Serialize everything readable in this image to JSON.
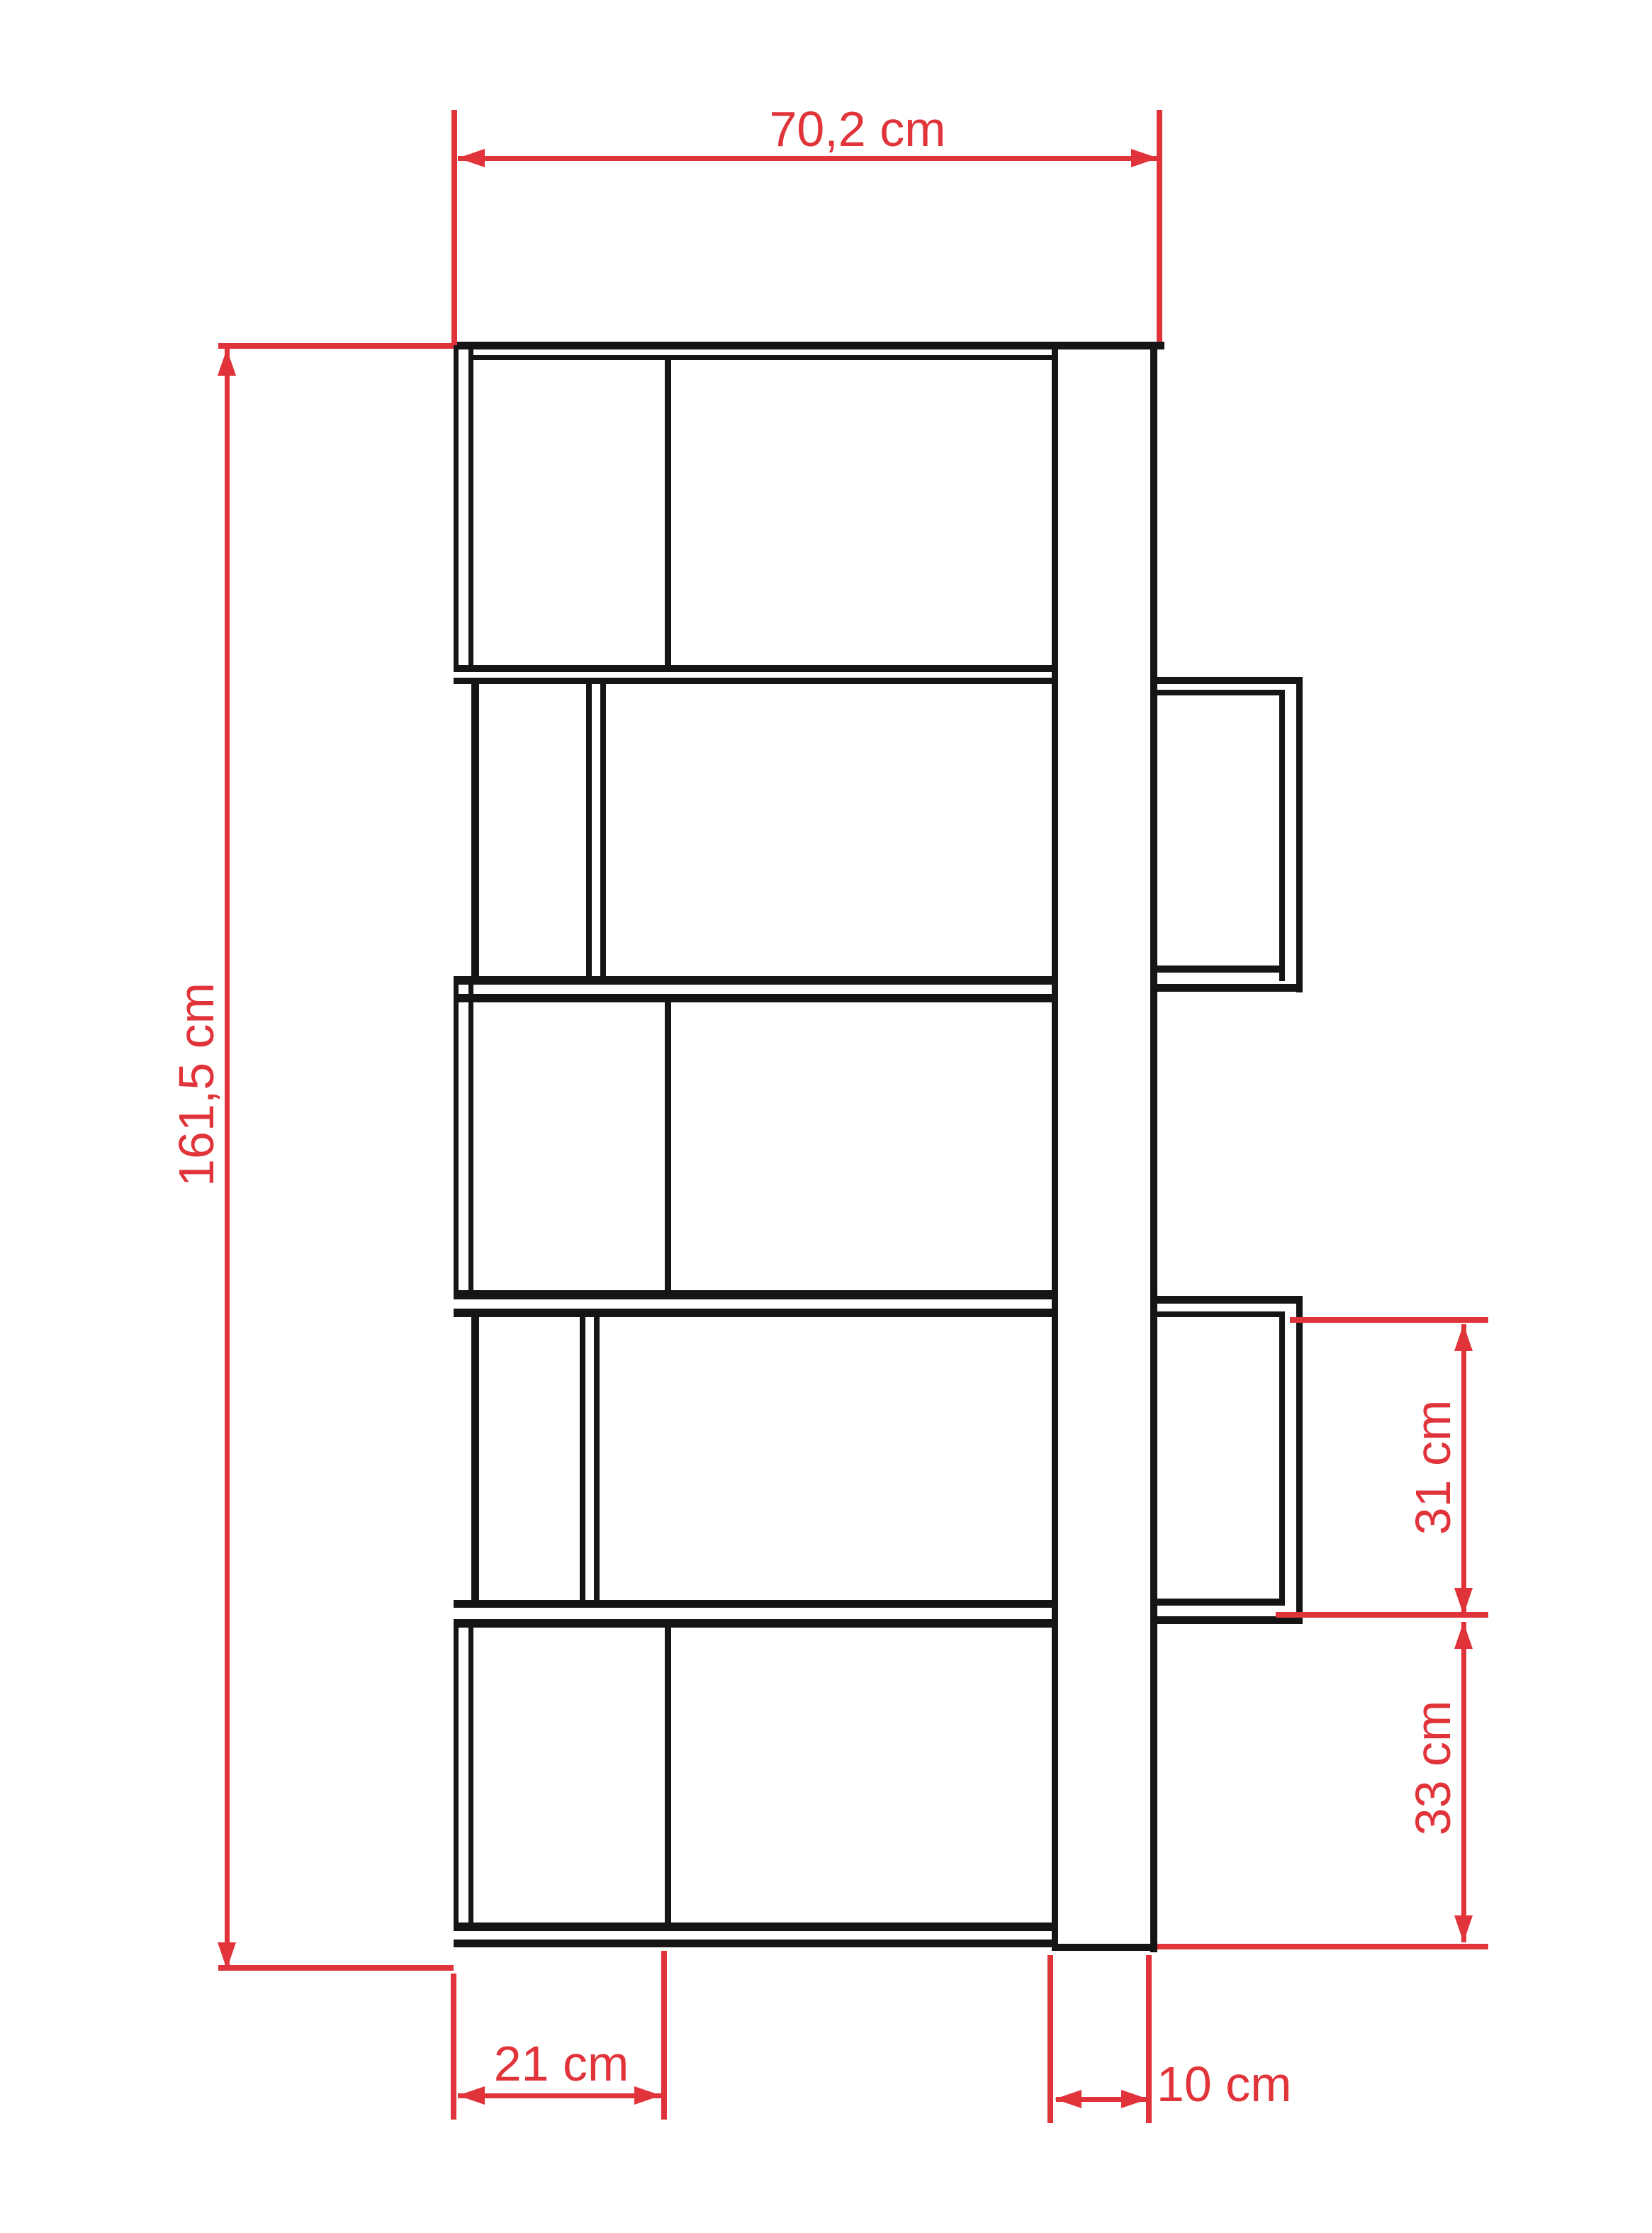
{
  "drawing": {
    "type": "furniture-technical-drawing",
    "subject": "bookcase side elevation with staggered compartments"
  },
  "colors": {
    "dimension_red": "#e0343a",
    "line_black": "#151515",
    "background": "#ffffff"
  },
  "dimensions": {
    "top_width": "70,2 cm",
    "left_height": "161,5 cm",
    "right_upper": "31 cm",
    "right_lower": "33 cm",
    "bottom_left": "21 cm",
    "bottom_right": "10 cm"
  }
}
